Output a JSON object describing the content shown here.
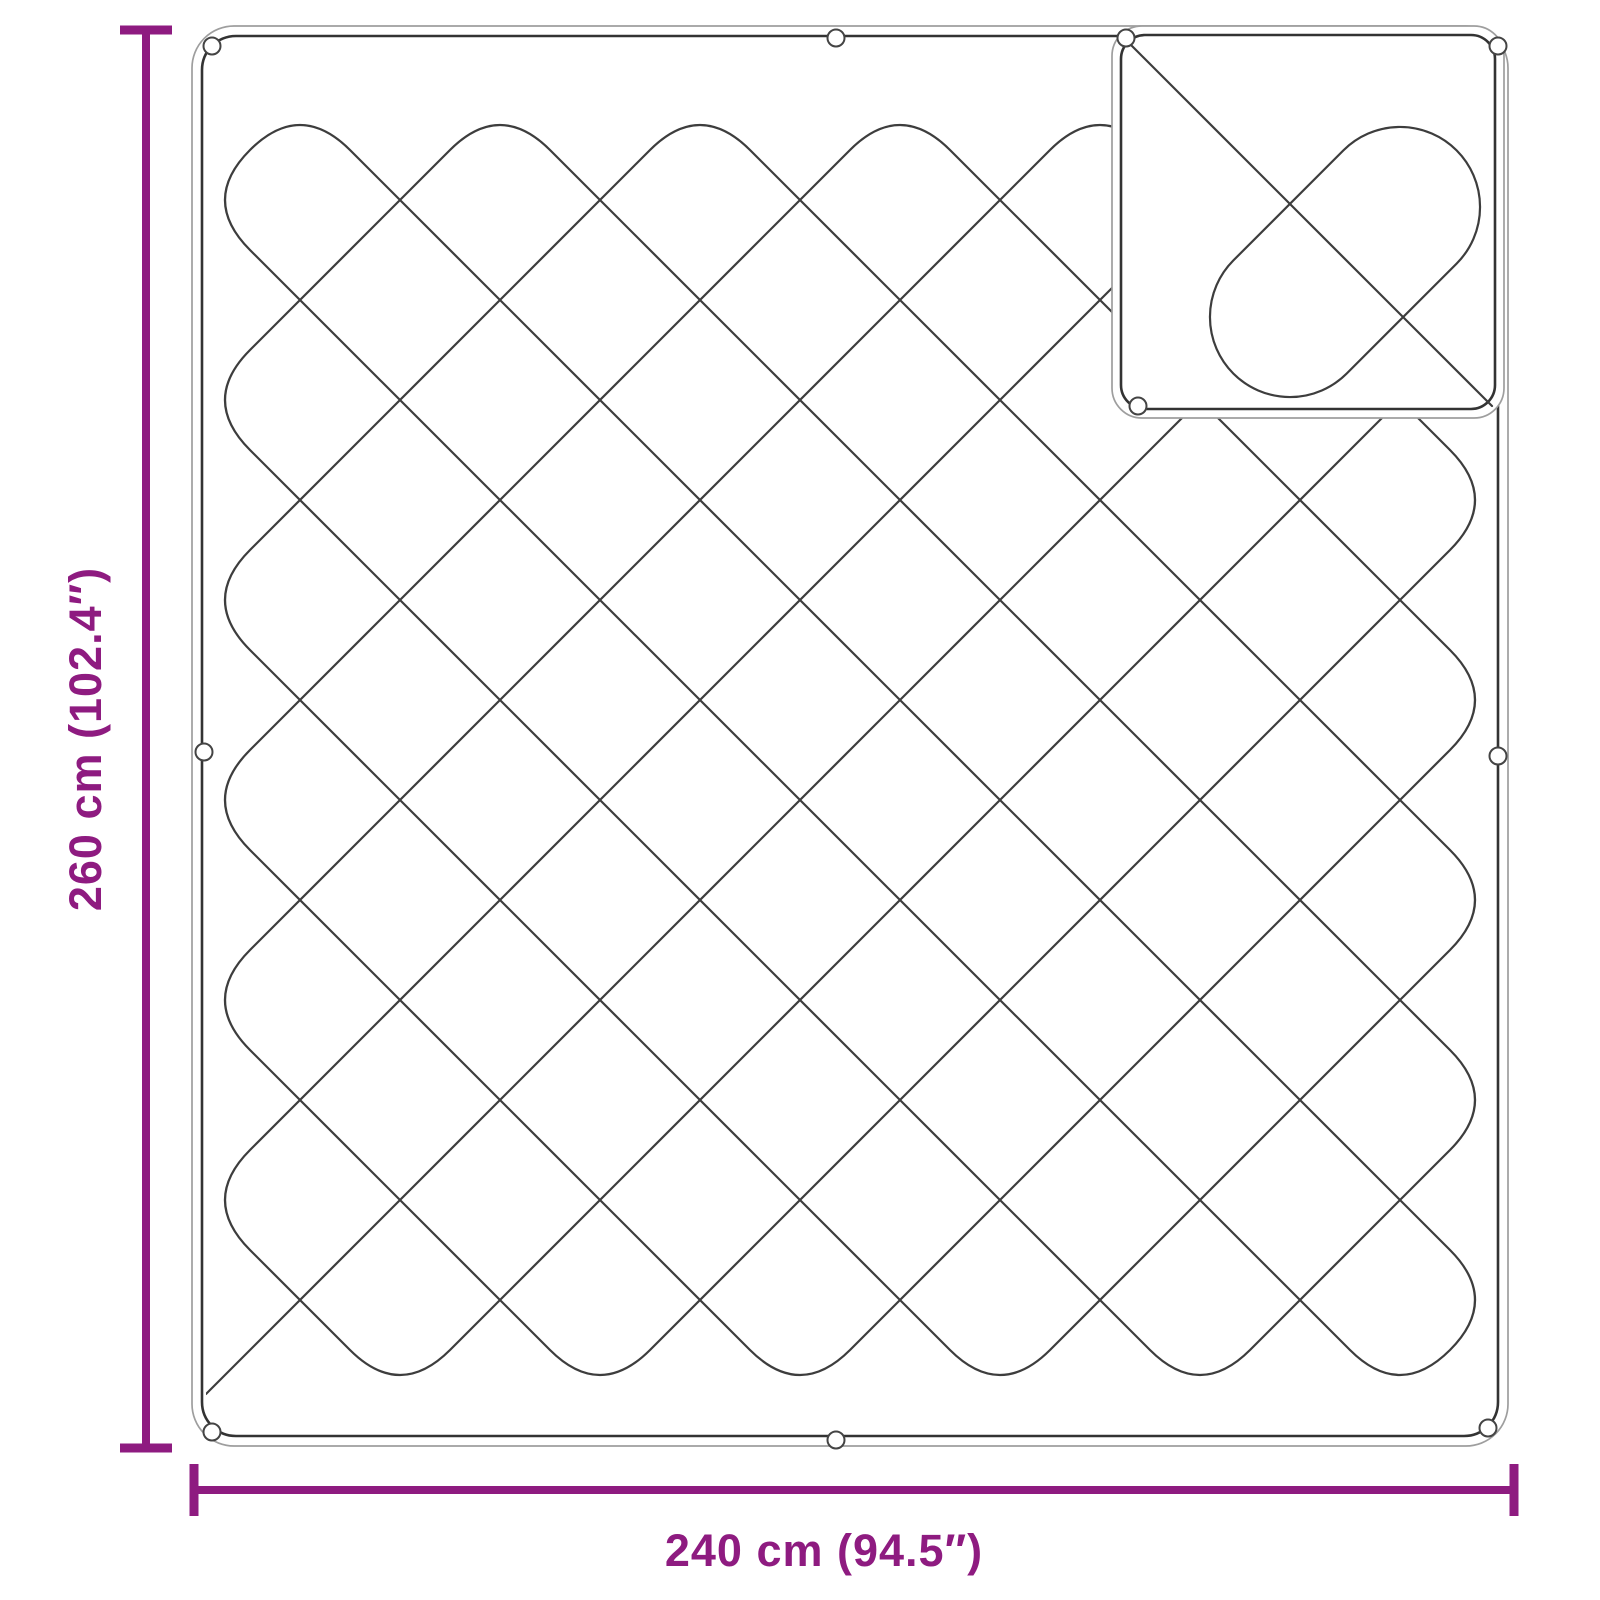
{
  "diagram": {
    "vertical_dimension": {
      "label": "260 cm (102.4″)"
    },
    "horizontal_dimension": {
      "label": "240 cm (94.5″)"
    }
  },
  "colors": {
    "dimension_accent": "#8e1b80",
    "drawing_line_dark": "#3d3d3d",
    "drawing_line_light": "#9e9e9e",
    "background": "#ffffff"
  }
}
